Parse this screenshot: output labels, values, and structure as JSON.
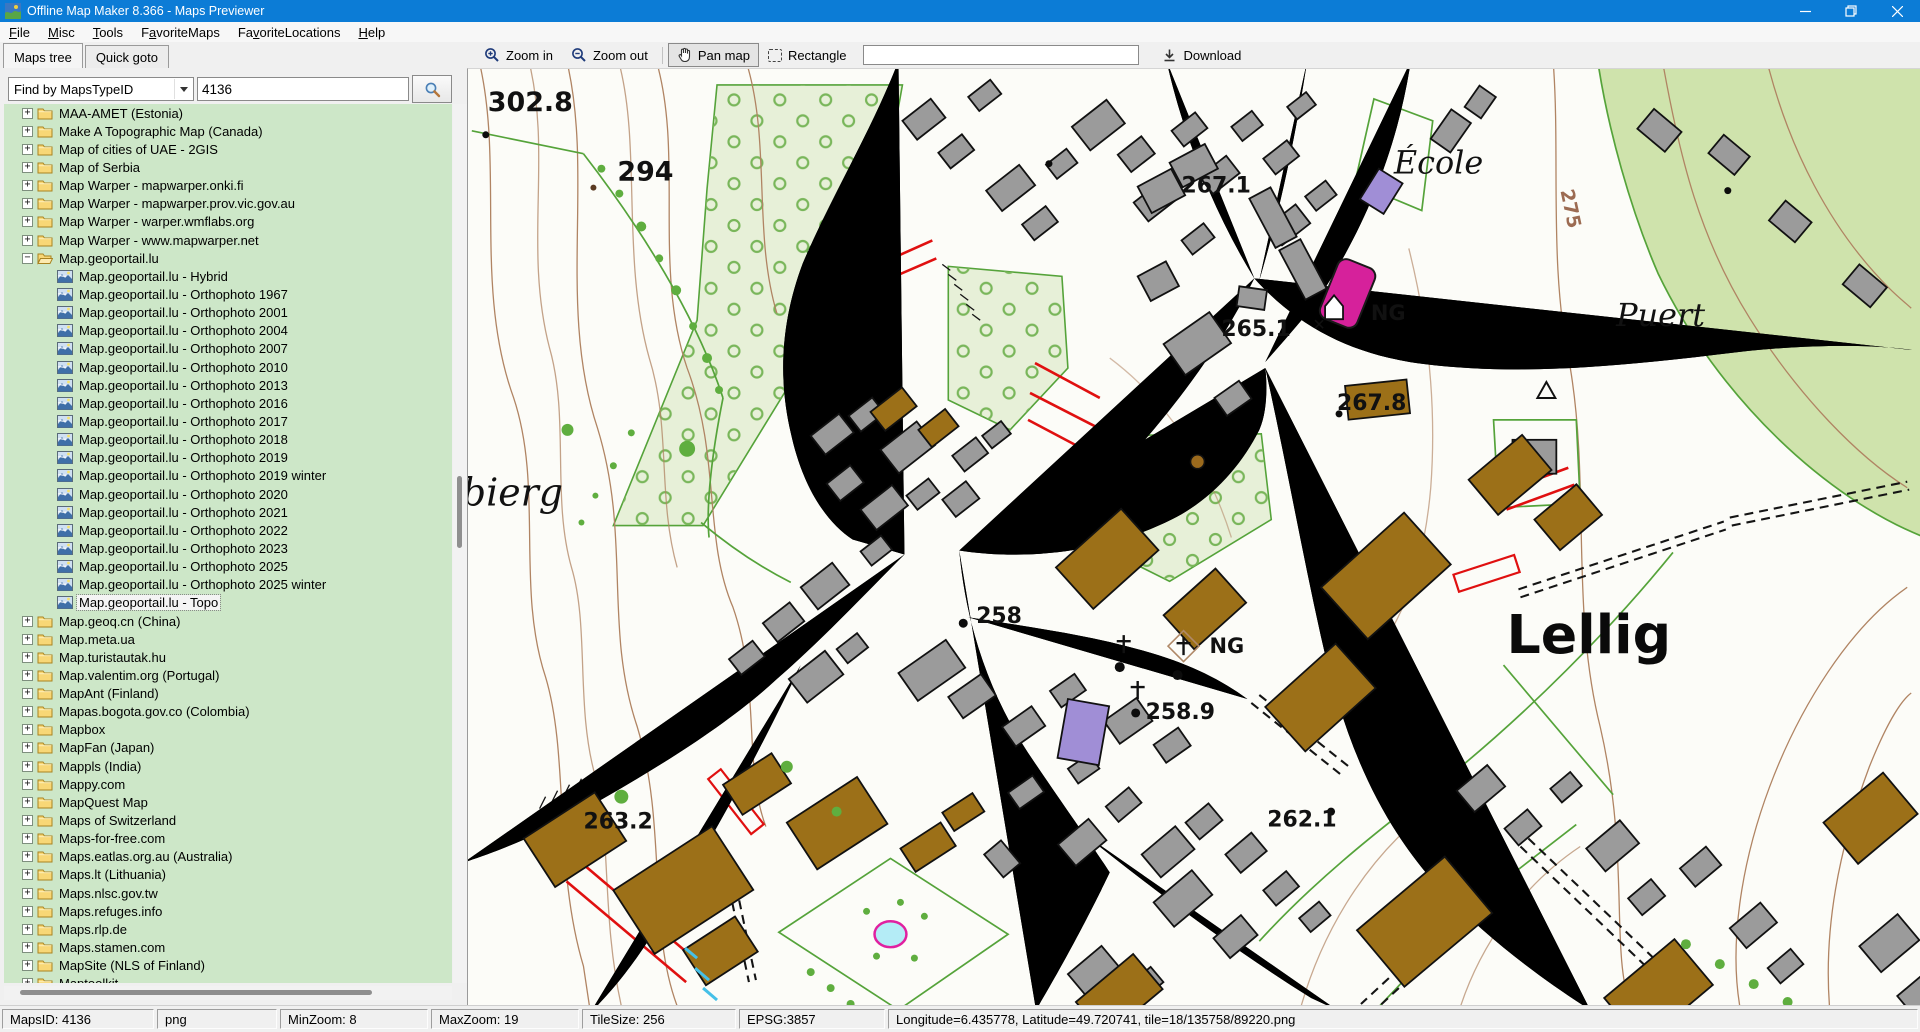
{
  "window": {
    "title": "Offline Map Maker 8.366 - Maps Previewer"
  },
  "menu": {
    "items": [
      {
        "label": "File",
        "accel": 0
      },
      {
        "label": "Misc",
        "accel": 0
      },
      {
        "label": "Tools",
        "accel": 0
      },
      {
        "label": "FavoriteMaps",
        "accel": 1
      },
      {
        "label": "FavoriteLocations",
        "accel": 2
      },
      {
        "label": "Help",
        "accel": 0
      }
    ]
  },
  "sidebar": {
    "tabs": [
      {
        "label": "Maps tree",
        "active": true
      },
      {
        "label": "Quick goto",
        "active": false
      }
    ],
    "search": {
      "mode": "Find by MapsTypeID",
      "value": "4136"
    },
    "tree_icons": {
      "collapsed": "+",
      "expanded": "−"
    },
    "tree": [
      {
        "label": "MAA-AMET (Estonia)",
        "type": "folder",
        "level": 0
      },
      {
        "label": "Make A Topographic Map (Canada)",
        "type": "folder",
        "level": 0
      },
      {
        "label": "Map of cities of UAE - 2GIS",
        "type": "folder",
        "level": 0
      },
      {
        "label": "Map of Serbia",
        "type": "folder",
        "level": 0
      },
      {
        "label": "Map Warper - mapwarper.onki.fi",
        "type": "folder",
        "level": 0
      },
      {
        "label": "Map Warper - mapwarper.prov.vic.gov.au",
        "type": "folder",
        "level": 0
      },
      {
        "label": "Map Warper - warper.wmflabs.org",
        "type": "folder",
        "level": 0
      },
      {
        "label": "Map Warper - www.mapwarper.net",
        "type": "folder",
        "level": 0
      },
      {
        "label": "Map.geoportail.lu",
        "type": "folder",
        "level": 0,
        "expanded": true
      },
      {
        "label": "Map.geoportail.lu - Hybrid",
        "type": "map",
        "level": 1
      },
      {
        "label": "Map.geoportail.lu - Orthophoto 1967",
        "type": "map",
        "level": 1
      },
      {
        "label": "Map.geoportail.lu - Orthophoto 2001",
        "type": "map",
        "level": 1
      },
      {
        "label": "Map.geoportail.lu - Orthophoto 2004",
        "type": "map",
        "level": 1
      },
      {
        "label": "Map.geoportail.lu - Orthophoto 2007",
        "type": "map",
        "level": 1
      },
      {
        "label": "Map.geoportail.lu - Orthophoto 2010",
        "type": "map",
        "level": 1
      },
      {
        "label": "Map.geoportail.lu - Orthophoto 2013",
        "type": "map",
        "level": 1
      },
      {
        "label": "Map.geoportail.lu - Orthophoto 2016",
        "type": "map",
        "level": 1
      },
      {
        "label": "Map.geoportail.lu - Orthophoto 2017",
        "type": "map",
        "level": 1
      },
      {
        "label": "Map.geoportail.lu - Orthophoto 2018",
        "type": "map",
        "level": 1
      },
      {
        "label": "Map.geoportail.lu - Orthophoto 2019",
        "type": "map",
        "level": 1
      },
      {
        "label": "Map.geoportail.lu - Orthophoto 2019 winter",
        "type": "map",
        "level": 1
      },
      {
        "label": "Map.geoportail.lu - Orthophoto 2020",
        "type": "map",
        "level": 1
      },
      {
        "label": "Map.geoportail.lu - Orthophoto 2021",
        "type": "map",
        "level": 1
      },
      {
        "label": "Map.geoportail.lu - Orthophoto 2022",
        "type": "map",
        "level": 1
      },
      {
        "label": "Map.geoportail.lu - Orthophoto 2023",
        "type": "map",
        "level": 1
      },
      {
        "label": "Map.geoportail.lu - Orthophoto 2025",
        "type": "map",
        "level": 1
      },
      {
        "label": "Map.geoportail.lu - Orthophoto 2025 winter",
        "type": "map",
        "level": 1
      },
      {
        "label": "Map.geoportail.lu - Topo",
        "type": "map",
        "level": 1,
        "selected": true
      },
      {
        "label": "Map.geoq.cn (China)",
        "type": "folder",
        "level": 0
      },
      {
        "label": "Map.meta.ua",
        "type": "folder",
        "level": 0
      },
      {
        "label": "Map.turistautak.hu",
        "type": "folder",
        "level": 0
      },
      {
        "label": "Map.valentim.org (Portugal)",
        "type": "folder",
        "level": 0
      },
      {
        "label": "MapAnt (Finland)",
        "type": "folder",
        "level": 0
      },
      {
        "label": "Mapas.bogota.gov.co (Colombia)",
        "type": "folder",
        "level": 0
      },
      {
        "label": "Mapbox",
        "type": "folder",
        "level": 0
      },
      {
        "label": "MapFan (Japan)",
        "type": "folder",
        "level": 0
      },
      {
        "label": "Mappls (India)",
        "type": "folder",
        "level": 0
      },
      {
        "label": "Mappy.com",
        "type": "folder",
        "level": 0
      },
      {
        "label": "MapQuest Map",
        "type": "folder",
        "level": 0
      },
      {
        "label": "Maps of Switzerland",
        "type": "folder",
        "level": 0
      },
      {
        "label": "Maps-for-free.com",
        "type": "folder",
        "level": 0
      },
      {
        "label": "Maps.eatlas.org.au (Australia)",
        "type": "folder",
        "level": 0
      },
      {
        "label": "Maps.lt (Lithuania)",
        "type": "folder",
        "level": 0
      },
      {
        "label": "Maps.nlsc.gov.tw",
        "type": "folder",
        "level": 0
      },
      {
        "label": "Maps.refuges.info",
        "type": "folder",
        "level": 0
      },
      {
        "label": "Maps.rlp.de",
        "type": "folder",
        "level": 0
      },
      {
        "label": "Maps.stamen.com",
        "type": "folder",
        "level": 0
      },
      {
        "label": "MapSite (NLS of Finland)",
        "type": "folder",
        "level": 0
      },
      {
        "label": "Maptoolkit",
        "type": "folder",
        "level": 0
      }
    ]
  },
  "toolbar": {
    "zoom_in": "Zoom in",
    "zoom_out": "Zoom out",
    "pan_map": "Pan map",
    "rectangle": "Rectangle",
    "input_value": "",
    "download": "Download"
  },
  "map": {
    "labels": {
      "elev_302_8": "302.8",
      "elev_294": "294",
      "ecole": "École",
      "contour_275": "275",
      "puert": "Puert",
      "elev_267_1": "267.1",
      "elev_265_1": "265.1",
      "elev_267_8": "267.8",
      "ng_top": "NG",
      "elev_258": "258",
      "ng_center": "NG",
      "elev_258_9": "258.9",
      "lellig": "Lellig",
      "elev_263_2": "263.2",
      "elev_262_1": "262.1",
      "bierg": "bierg"
    },
    "colors": {
      "forest": "#cfe3ac",
      "orchard": "#e7f0d8",
      "building_gray": "#9b9b9b",
      "building_farm": "#9c7018",
      "building_landmark": "#d6219b",
      "building_public": "#a08ed6",
      "water": "#b4ecf6",
      "contour": "#b08463",
      "road": "#141414",
      "field_boundary": "#55a33a",
      "accent_red": "#e01010"
    }
  },
  "statusbar": {
    "cells": [
      "MapsID: 4136",
      "png",
      "MinZoom: 8",
      "MaxZoom: 19",
      "TileSize: 256",
      "EPSG:3857",
      "Longitude=6.435778, Latitude=49.720741, tile=18/135758/89220.png"
    ]
  }
}
